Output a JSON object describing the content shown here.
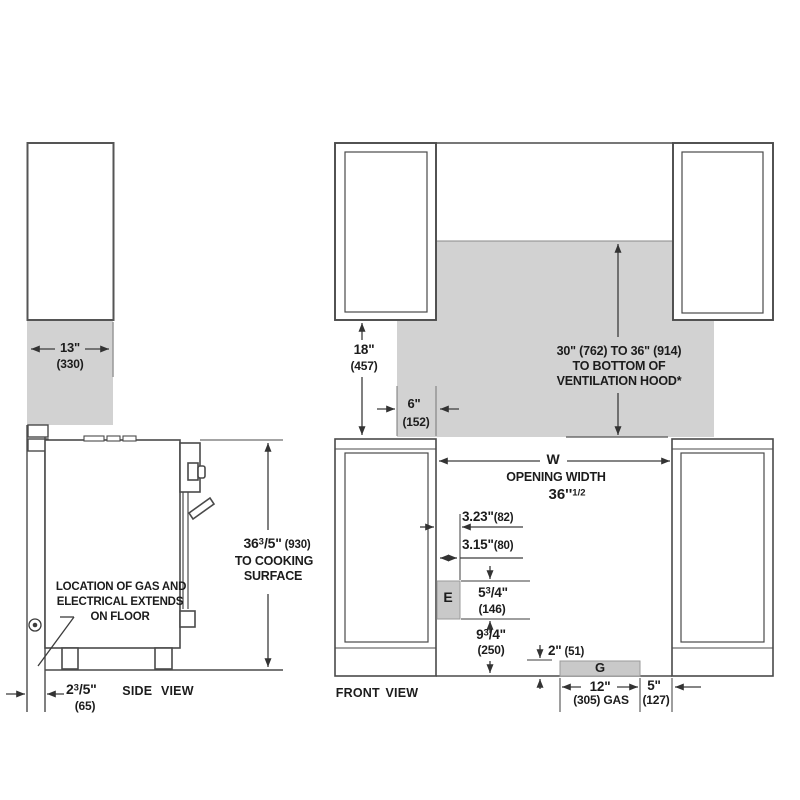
{
  "side_view": {
    "title": "SIDE VIEW",
    "cabinet_width": {
      "in": "13\"",
      "mm": "(330)"
    },
    "cooking_height": {
      "int": "36",
      "num": "3",
      "den": "/5\"",
      "mm": "(930)",
      "note1": "TO COOKING",
      "note2": "SURFACE"
    },
    "wall_gap": {
      "int": "2",
      "num": "3",
      "den": "/5\"",
      "mm": "(65)"
    },
    "gas_note": {
      "line1": "LOCATION OF GAS AND",
      "line2": "ELECTRICAL EXTENDS",
      "line3": "ON FLOOR"
    }
  },
  "front_view": {
    "title": "FRONT VIEW",
    "upper_cabinet_height": {
      "in": "18\"",
      "mm": "(457)"
    },
    "side_clearance": {
      "in": "6\"",
      "mm": "(152)"
    },
    "hood": {
      "line1": "30\" (762) TO 36\" (914)",
      "line2": "TO BOTTOM OF",
      "line3": "VENTILATION HOOD*"
    },
    "opening": {
      "symbol": "W",
      "label": "OPENING WIDTH",
      "int": "36''",
      "sup": "1/2"
    },
    "dim_a": {
      "in": "3.23\"",
      "mm": "(82)"
    },
    "dim_b": {
      "in": "3.15\"",
      "mm": "(80)"
    },
    "electric": {
      "symbol": "E"
    },
    "dim_e_height": {
      "int": "5",
      "num": "3",
      "den": "/4\"",
      "mm": "(146)"
    },
    "dim_e_floor": {
      "int": "9",
      "num": "3",
      "den": "/4\"",
      "mm": "(250)"
    },
    "dim_gas_height": {
      "in": "2\"",
      "mm": "(51)"
    },
    "gas": {
      "symbol": "G"
    },
    "dim_gas_width": {
      "in": "12\"",
      "mm": "(305) GAS"
    },
    "dim_gas_offset": {
      "in": "5\"",
      "mm": "(127)"
    }
  },
  "colors": {
    "shade": "#d2d2d2",
    "box_shade": "#c9c9c9",
    "line": "#4a4a4a",
    "dim_line": "#3c3c3c",
    "text": "#1c1c1c"
  }
}
